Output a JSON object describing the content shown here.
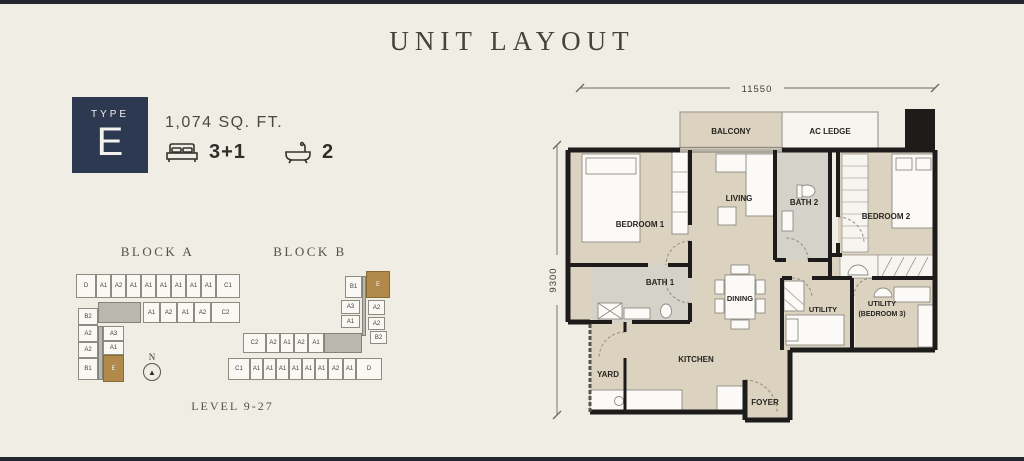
{
  "page": {
    "title": "UNIT LAYOUT"
  },
  "unit": {
    "type_label": "TYPE",
    "type_value": "E",
    "area": "1,074 SQ. FT.",
    "bed_count": "3+1",
    "bath_count": "2"
  },
  "site": {
    "north": "N",
    "level": "LEVEL 9-27",
    "block_a": {
      "name": "BLOCK A",
      "cells": [
        {
          "label": "D",
          "x": 14,
          "y": 12,
          "w": 20,
          "h": 24
        },
        {
          "label": "A1",
          "x": 34,
          "y": 12,
          "w": 15,
          "h": 24
        },
        {
          "label": "A2",
          "x": 49,
          "y": 12,
          "w": 15,
          "h": 24
        },
        {
          "label": "A1",
          "x": 64,
          "y": 12,
          "w": 15,
          "h": 24
        },
        {
          "label": "A1",
          "x": 79,
          "y": 12,
          "w": 15,
          "h": 24
        },
        {
          "label": "A1",
          "x": 94,
          "y": 12,
          "w": 15,
          "h": 24
        },
        {
          "label": "A1",
          "x": 109,
          "y": 12,
          "w": 15,
          "h": 24
        },
        {
          "label": "A1",
          "x": 124,
          "y": 12,
          "w": 15,
          "h": 24
        },
        {
          "label": "A1",
          "x": 139,
          "y": 12,
          "w": 15,
          "h": 24
        },
        {
          "label": "C1",
          "x": 154,
          "y": 12,
          "w": 24,
          "h": 24
        },
        {
          "label": "",
          "x": 36,
          "y": 40,
          "w": 43,
          "h": 21,
          "core": true
        },
        {
          "label": "A1",
          "x": 81,
          "y": 40,
          "w": 17,
          "h": 21
        },
        {
          "label": "A2",
          "x": 98,
          "y": 40,
          "w": 17,
          "h": 21
        },
        {
          "label": "A1",
          "x": 115,
          "y": 40,
          "w": 17,
          "h": 21
        },
        {
          "label": "A2",
          "x": 132,
          "y": 40,
          "w": 17,
          "h": 21
        },
        {
          "label": "C2",
          "x": 149,
          "y": 40,
          "w": 29,
          "h": 21
        },
        {
          "label": "B2",
          "x": 16,
          "y": 46,
          "w": 20,
          "h": 17
        },
        {
          "label": "A2",
          "x": 16,
          "y": 63,
          "w": 20,
          "h": 17
        },
        {
          "label": "A2",
          "x": 16,
          "y": 80,
          "w": 20,
          "h": 16
        },
        {
          "label": "B1",
          "x": 16,
          "y": 96,
          "w": 20,
          "h": 22
        },
        {
          "label": "",
          "x": 36,
          "y": 64,
          "w": 5,
          "h": 54,
          "core": true
        },
        {
          "label": "A3",
          "x": 41,
          "y": 64,
          "w": 21,
          "h": 15
        },
        {
          "label": "A1",
          "x": 41,
          "y": 79,
          "w": 21,
          "h": 14
        },
        {
          "label": "E",
          "x": 41,
          "y": 93,
          "w": 21,
          "h": 27,
          "hl": true
        }
      ]
    },
    "block_b": {
      "name": "BLOCK B",
      "cells": [
        {
          "label": "B1",
          "x": 120,
          "y": 14,
          "w": 17,
          "h": 22
        },
        {
          "label": "E",
          "x": 141,
          "y": 9,
          "w": 24,
          "h": 27,
          "hl": true
        },
        {
          "label": "",
          "x": 137,
          "y": 14,
          "w": 4,
          "h": 60,
          "core": true
        },
        {
          "label": "A3",
          "x": 116,
          "y": 38,
          "w": 19,
          "h": 14
        },
        {
          "label": "A2",
          "x": 143,
          "y": 38,
          "w": 17,
          "h": 15
        },
        {
          "label": "A1",
          "x": 116,
          "y": 53,
          "w": 19,
          "h": 13
        },
        {
          "label": "A2",
          "x": 143,
          "y": 55,
          "w": 17,
          "h": 13
        },
        {
          "label": "B2",
          "x": 145,
          "y": 69,
          "w": 17,
          "h": 13
        },
        {
          "label": "C2",
          "x": 18,
          "y": 71,
          "w": 23,
          "h": 20
        },
        {
          "label": "A2",
          "x": 41,
          "y": 71,
          "w": 14,
          "h": 20
        },
        {
          "label": "A1",
          "x": 55,
          "y": 71,
          "w": 14,
          "h": 20
        },
        {
          "label": "A2",
          "x": 69,
          "y": 71,
          "w": 14,
          "h": 20
        },
        {
          "label": "A1",
          "x": 83,
          "y": 71,
          "w": 16,
          "h": 20
        },
        {
          "label": "",
          "x": 99,
          "y": 71,
          "w": 38,
          "h": 20,
          "core": true
        },
        {
          "label": "C1",
          "x": 3,
          "y": 96,
          "w": 22,
          "h": 22
        },
        {
          "label": "A1",
          "x": 25,
          "y": 96,
          "w": 13,
          "h": 22
        },
        {
          "label": "A1",
          "x": 38,
          "y": 96,
          "w": 13,
          "h": 22
        },
        {
          "label": "A1",
          "x": 51,
          "y": 96,
          "w": 13,
          "h": 22
        },
        {
          "label": "A1",
          "x": 64,
          "y": 96,
          "w": 13,
          "h": 22
        },
        {
          "label": "A1",
          "x": 77,
          "y": 96,
          "w": 13,
          "h": 22
        },
        {
          "label": "A1",
          "x": 90,
          "y": 96,
          "w": 13,
          "h": 22
        },
        {
          "label": "A2",
          "x": 103,
          "y": 96,
          "w": 15,
          "h": 22
        },
        {
          "label": "A1",
          "x": 118,
          "y": 96,
          "w": 13,
          "h": 22
        },
        {
          "label": "D",
          "x": 131,
          "y": 96,
          "w": 26,
          "h": 22
        }
      ]
    }
  },
  "plan": {
    "dims": {
      "width": "11550",
      "height": "9300"
    },
    "labels": {
      "balcony": "BALCONY",
      "ac_ledge": "AC LEDGE",
      "bedroom1": "BEDROOM 1",
      "living": "LIVING",
      "bath2": "BATH 2",
      "bedroom2": "BEDROOM 2",
      "bath1": "BATH 1",
      "dining": "DINING",
      "utility": "UTILITY",
      "utility3_l1": "UTILITY",
      "utility3_l2": "(BEDROOM 3)",
      "yard": "YARD",
      "kitchen": "KITCHEN",
      "foyer": "FOYER"
    }
  },
  "colors": {
    "navy": "#2c3950",
    "gold": "#b1894b",
    "beige": "#dbd2bf",
    "wall": "#1d1c1a"
  }
}
